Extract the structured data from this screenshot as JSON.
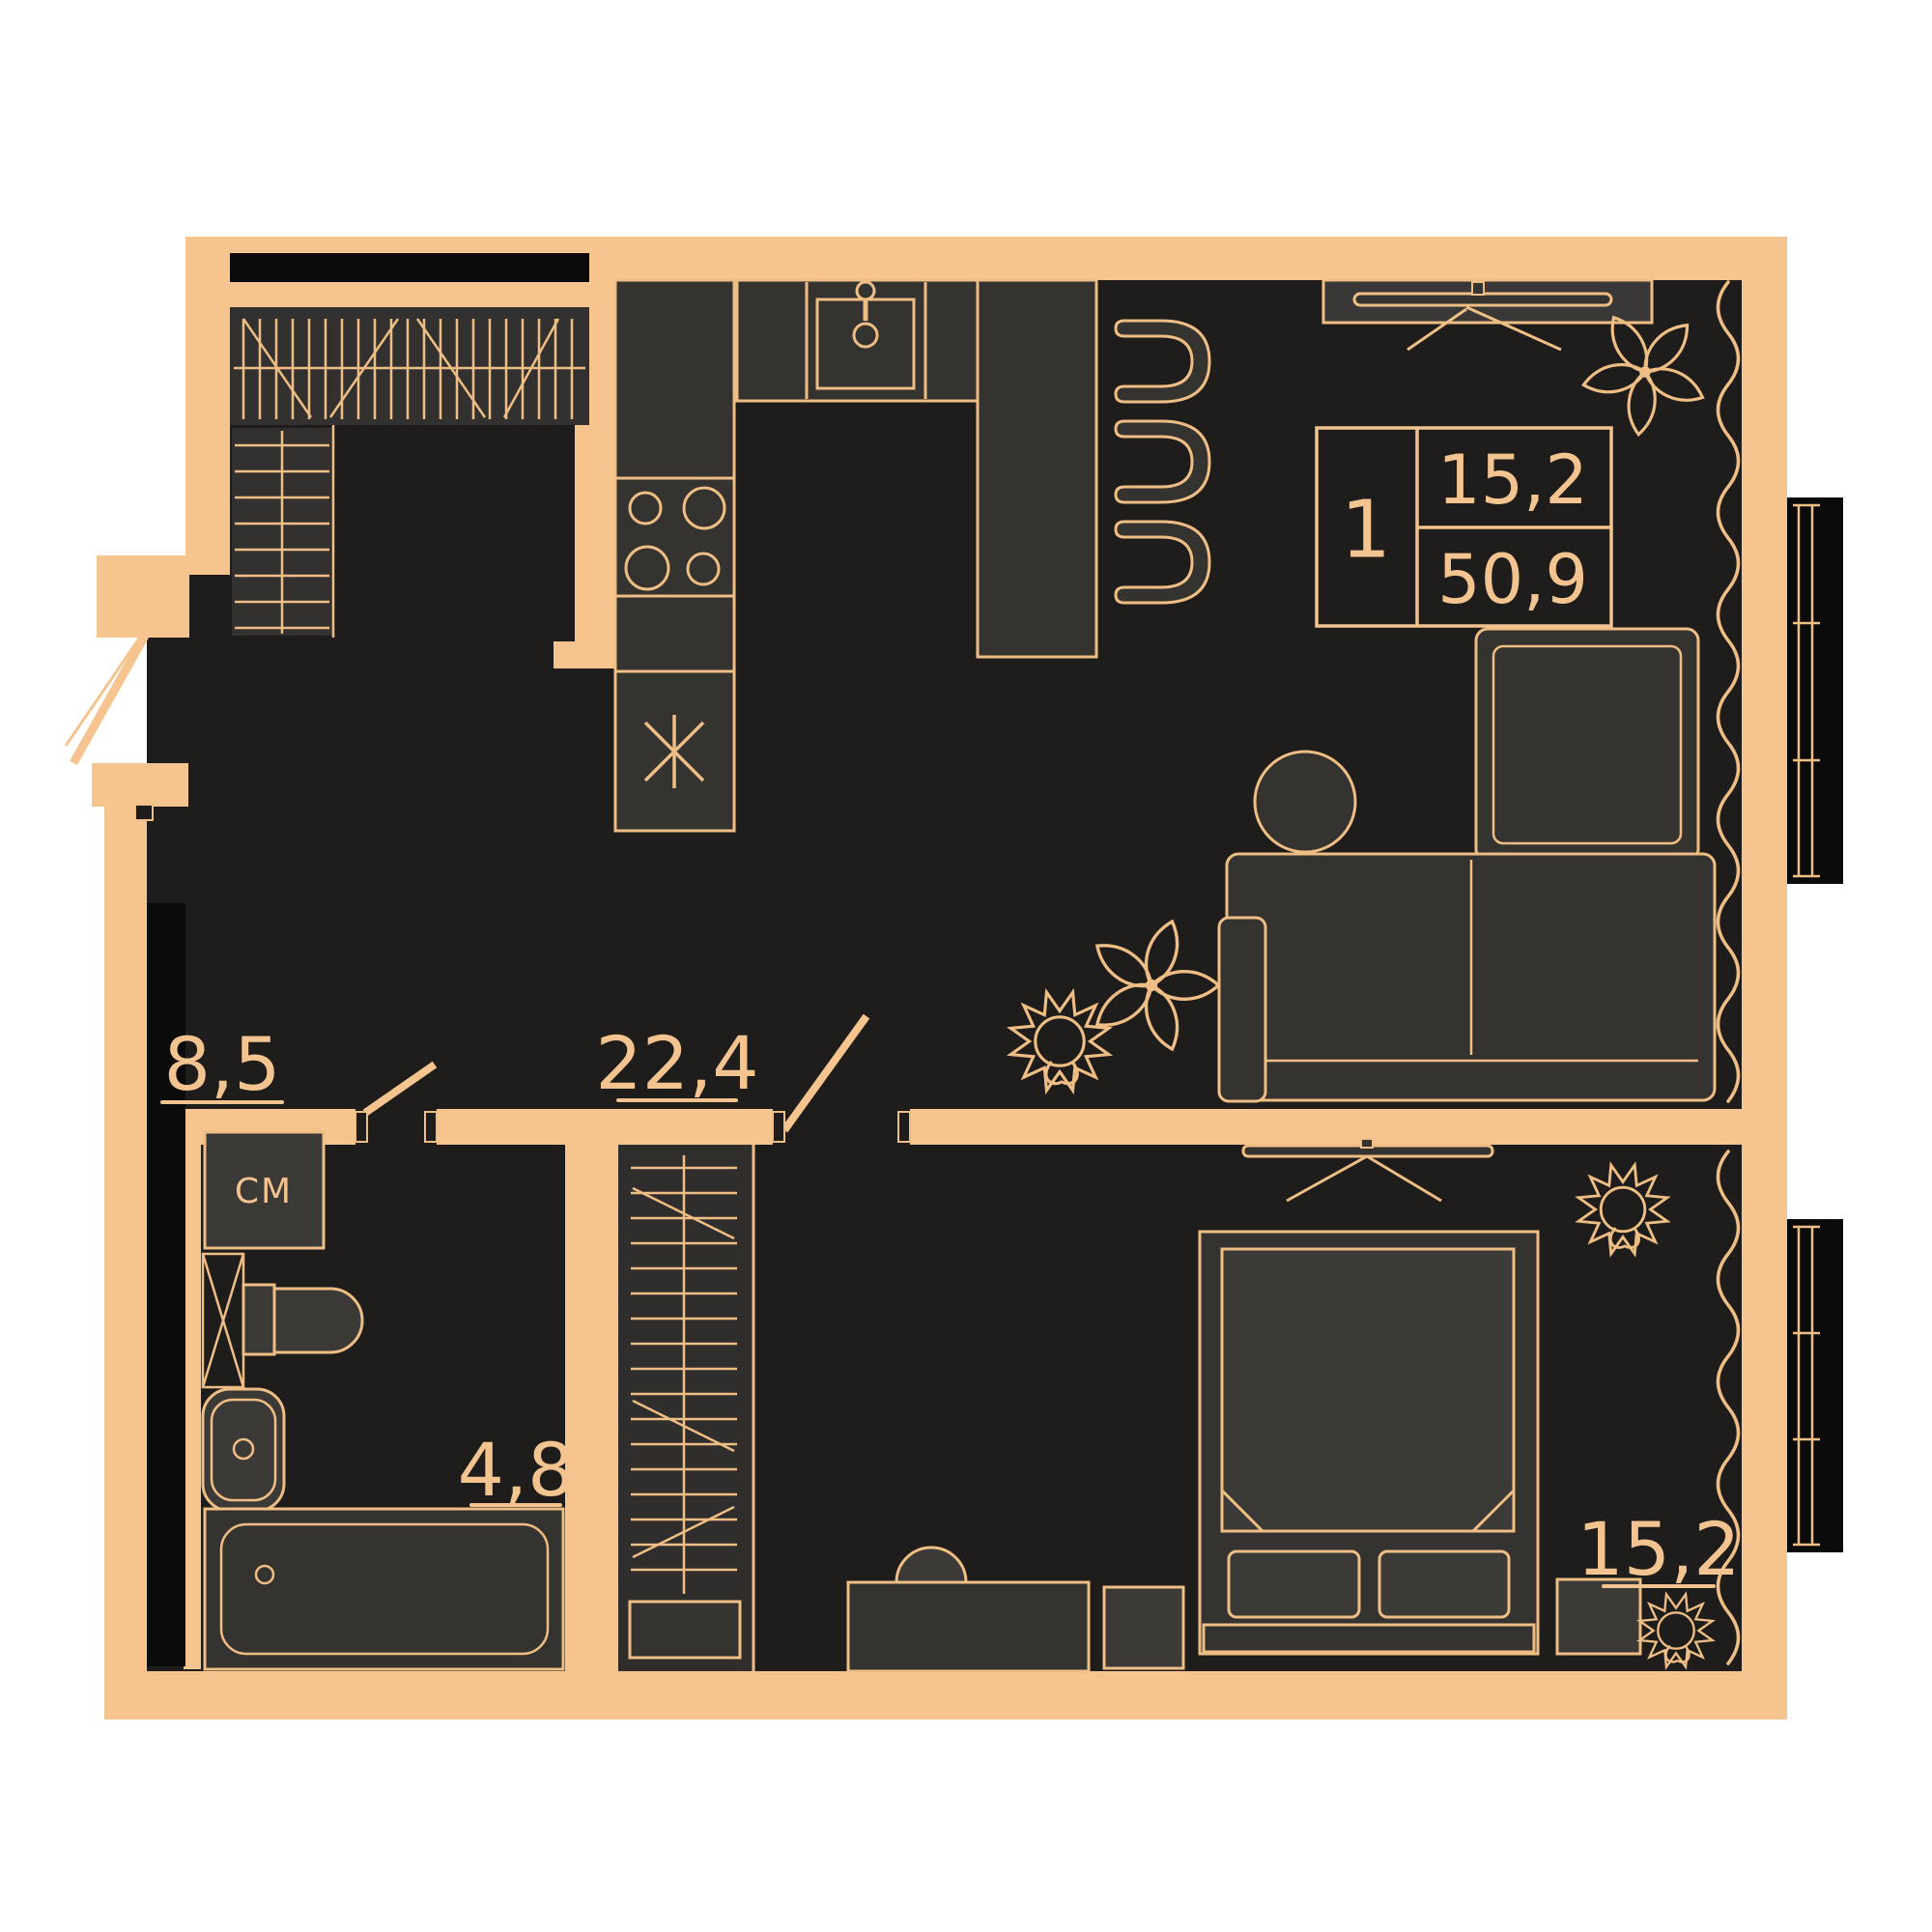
{
  "colors": {
    "wall": "#F6C48E",
    "outline": "#EFBE85",
    "floor": "#1E1D1C",
    "furniture": "#34332F",
    "furniture_light": "#3B3A37",
    "accent_black": "#0B0B0B",
    "text": "#F3C48F",
    "background": "#FFFFFF"
  },
  "legend": {
    "rooms_count": "1",
    "living_area": "15,2",
    "total_area": "50,9"
  },
  "rooms": {
    "hallway": {
      "label": "8,5"
    },
    "kitchen_living": {
      "label": "22,4"
    },
    "bathroom": {
      "label": "4,8"
    },
    "bedroom": {
      "label": "15,2"
    }
  },
  "labels": {
    "washing_machine": "СМ"
  }
}
